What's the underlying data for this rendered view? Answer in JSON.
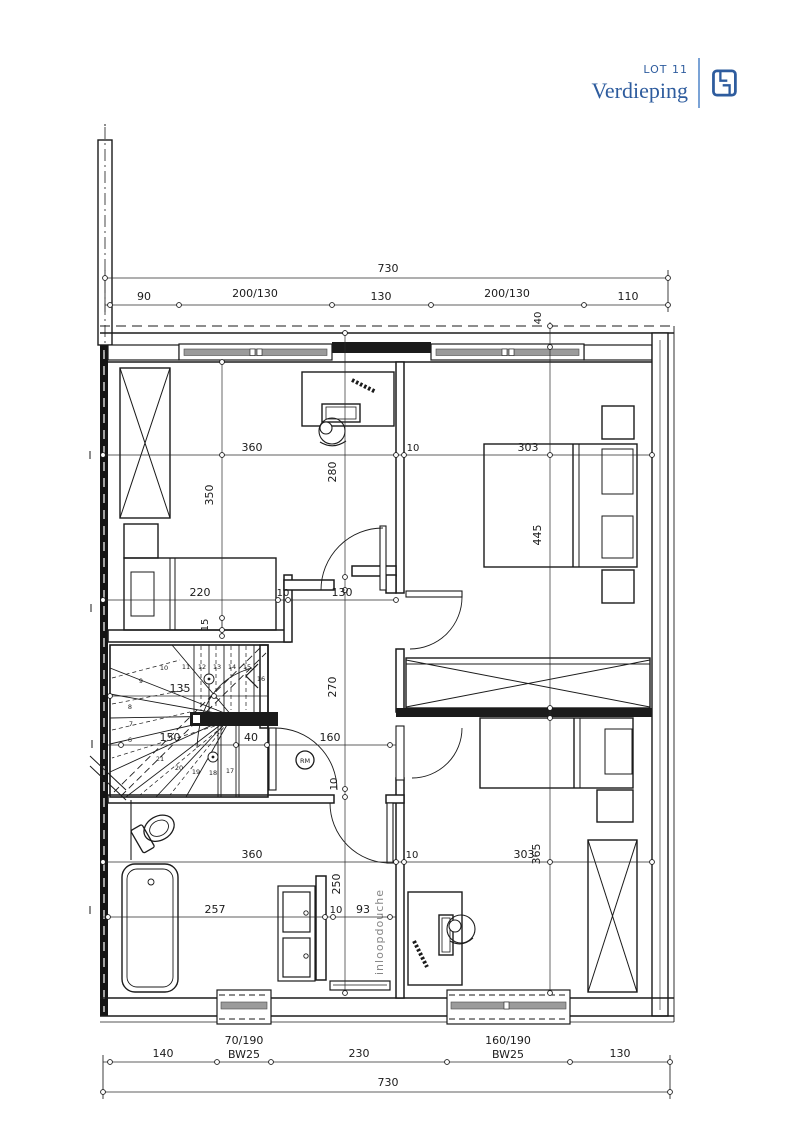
{
  "header": {
    "lot": "LOT 11",
    "title": "Verdieping"
  },
  "colors": {
    "accent": "#2e5c9e",
    "line": "#1b1b1b",
    "glazing": "#9b9b9b",
    "text_gray": "#858585"
  },
  "dims": {
    "top_total": "730",
    "top_chain": [
      "90",
      "200/130",
      "130",
      "200/130",
      "110"
    ],
    "top_offset": "40",
    "upper_width": [
      "360",
      "10",
      "303"
    ],
    "room1_depth": "350",
    "room1_inner": "280",
    "room2_depth": "445",
    "bed_line": [
      "220",
      "10",
      "130"
    ],
    "bed_gap": "15",
    "hall_depth": "270",
    "hall_line": [
      "150",
      "40",
      "160"
    ],
    "hall_gap": "10",
    "stair_width": "135",
    "lower_width": [
      "360",
      "10",
      "303"
    ],
    "room3_depth": "365",
    "bath_line": [
      "257",
      "10",
      "93"
    ],
    "shower_len": "250",
    "bottom_chain": [
      "140",
      "230",
      "130"
    ],
    "bottom_windows": [
      {
        "size": "70/190",
        "code": "BW25"
      },
      {
        "size": "160/190",
        "code": "BW25"
      }
    ],
    "bottom_total": "730"
  },
  "labels": {
    "shower": "inloopdouche",
    "smoke": "RM"
  },
  "stairs": {
    "treads": [
      "6",
      "7",
      "8",
      "9",
      "10",
      "11",
      "12",
      "13",
      "14",
      "15",
      "16",
      "17",
      "18",
      "19",
      "20",
      "21"
    ]
  }
}
